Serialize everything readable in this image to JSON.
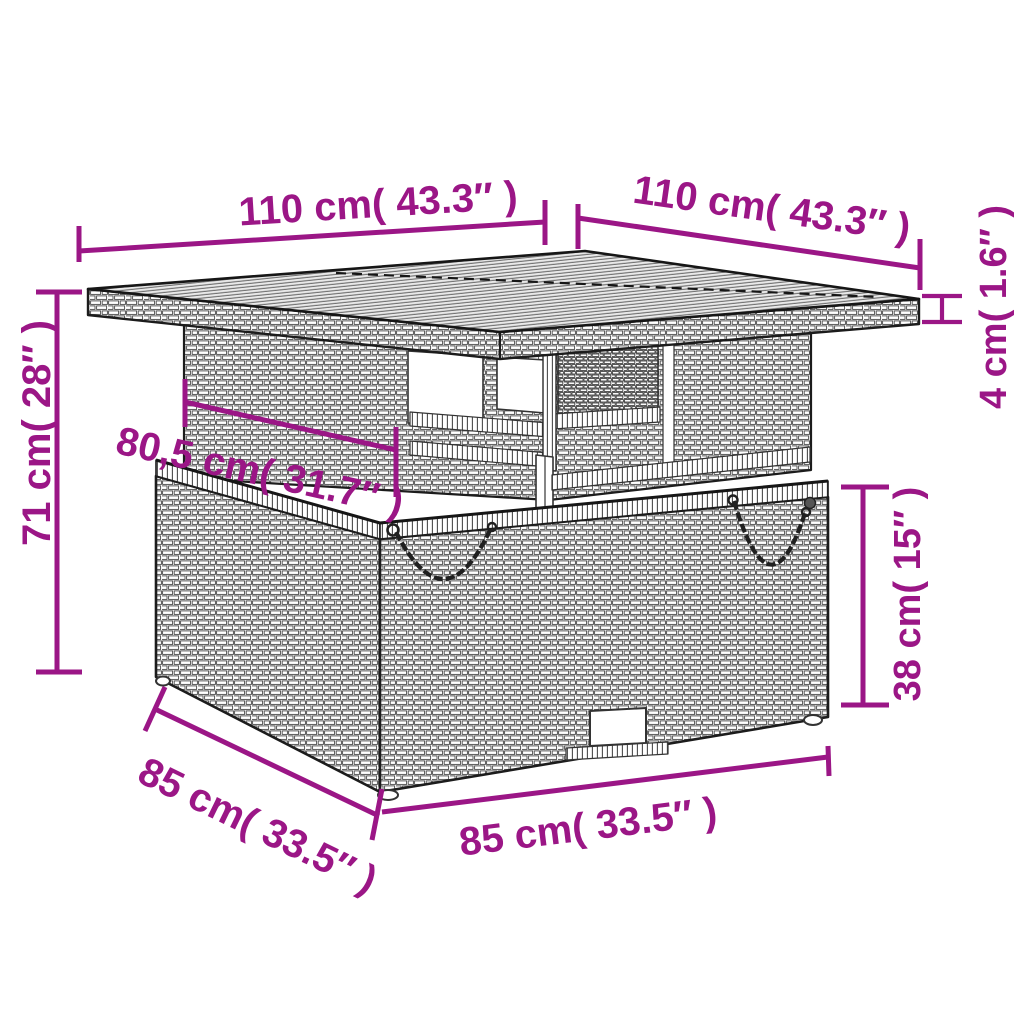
{
  "diagram": {
    "accent_color": "#9B1686",
    "outline_color": "#1c1c1c",
    "product": "rattan-lift-top-garden-table",
    "dimensions": {
      "top_width": "110 cm( 43.3″ )",
      "top_depth": "110 cm( 43.3″ )",
      "top_thickness": "4 cm( 1.6″ )",
      "total_height": "71 cm( 28″ )",
      "apron_width": "80,5 cm( 31.7″ )",
      "base_height": "38 cm( 15″ )",
      "base_depth": "85 cm( 33.5″ )",
      "base_width": "85 cm( 33.5″ )"
    }
  }
}
